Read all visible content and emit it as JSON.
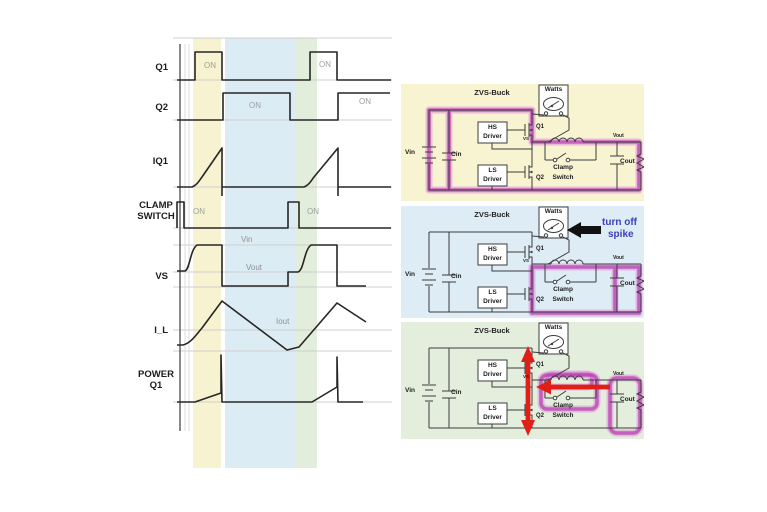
{
  "waveforms": {
    "rows": [
      {
        "label": "Q1",
        "on1": "ON",
        "on2": "ON"
      },
      {
        "label": "Q2",
        "on1": "ON",
        "on2": "ON"
      },
      {
        "label": "IQ1"
      },
      {
        "label": "CLAMP\nSWITCH",
        "on1": "ON",
        "on2": "ON"
      },
      {
        "label": "VS",
        "vin_level": "Vin",
        "vout_level": "Vout"
      },
      {
        "label": "I_L",
        "iout_level": "Iout"
      },
      {
        "label": "POWER\nQ1"
      }
    ],
    "timing_pct_of_window": {
      "q1_on": [
        [
          8,
          21
        ],
        [
          62,
          75
        ]
      ],
      "q2_on": [
        [
          21,
          53
        ],
        [
          75,
          100
        ]
      ],
      "clamp_on": [
        [
          0,
          3
        ],
        [
          52,
          57
        ]
      ],
      "iq1": "ramps up while Q1 is ON, drops to zero at Q1 turn-off",
      "vs": "rises to Vin when Q1 on, falls low when Q2 on, steps at Vout before rising",
      "i_l": "triangular ripple around Iout average",
      "power_q1": "small conduction ramp with tall spike at Q1 turn-off"
    }
  },
  "panels": [
    {
      "title": "ZVS-Buck",
      "meter": "Watts",
      "hs_driver": "HS\nDriver",
      "ls_driver": "LS\nDriver",
      "vin": "Vin",
      "cin": "Cin",
      "q1": "Q1",
      "q2": "Q2",
      "vs": "VS",
      "clamp": "Clamp\nSwitch",
      "vout": "Vout",
      "cout": "Cout"
    },
    {
      "title": "ZVS-Buck",
      "meter": "Watts",
      "hs_driver": "HS\nDriver",
      "ls_driver": "LS\nDriver",
      "vin": "Vin",
      "cin": "Cin",
      "q1": "Q1",
      "q2": "Q2",
      "vs": "VS",
      "clamp": "Clamp\nSwitch",
      "vout": "Vout",
      "cout": "Cout",
      "note_line1": "turn off",
      "note_line2": "spike"
    },
    {
      "title": "ZVS-Buck",
      "meter": "Watts",
      "hs_driver": "HS\nDriver",
      "ls_driver": "LS\nDriver",
      "vin": "Vin",
      "cin": "Cin",
      "q1": "Q1",
      "q2": "Q2",
      "vs": "VS",
      "clamp": "Clamp\nSwitch",
      "vout": "Vout",
      "cout": "Cout"
    }
  ],
  "colors": {
    "band_yellow": "#f8f3d1",
    "band_blue": "#ddecf5",
    "band_green": "#e4eedd",
    "highlight_magenta": "#af2ca8",
    "arrow_red": "#e02018",
    "annotation_blue": "#3c3fbb",
    "trace": "#262626",
    "grid": "#cfcfcf"
  }
}
